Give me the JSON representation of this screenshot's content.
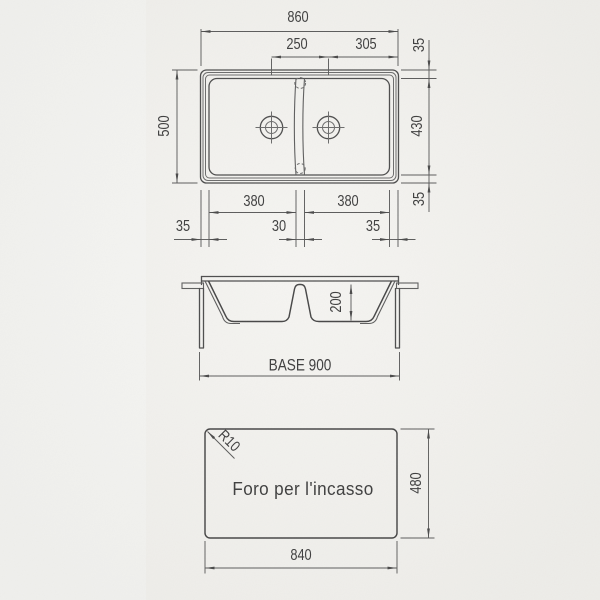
{
  "meta": {
    "background_color": "#f2f1ed",
    "line_color": "#4e4e4e",
    "text_color": "#424242",
    "drawing_type": "sink installation drawing"
  },
  "top_view": {
    "overall_width": "860",
    "drain_spacing": "250",
    "drain_to_right_edge": "305",
    "rim_top": "35",
    "overall_depth": "500",
    "bowl_depth": "430",
    "rim_bottom": "35",
    "rim_left": "35",
    "left_bowl_width": "380",
    "divider_width": "30",
    "right_bowl_width": "380",
    "rim_right": "35"
  },
  "section_view": {
    "bowl_height": "200",
    "base": "BASE 900"
  },
  "cutout_view": {
    "corner_radius": "R10",
    "caption": "Foro per l'incasso",
    "cutout_height": "480",
    "cutout_width": "840"
  }
}
